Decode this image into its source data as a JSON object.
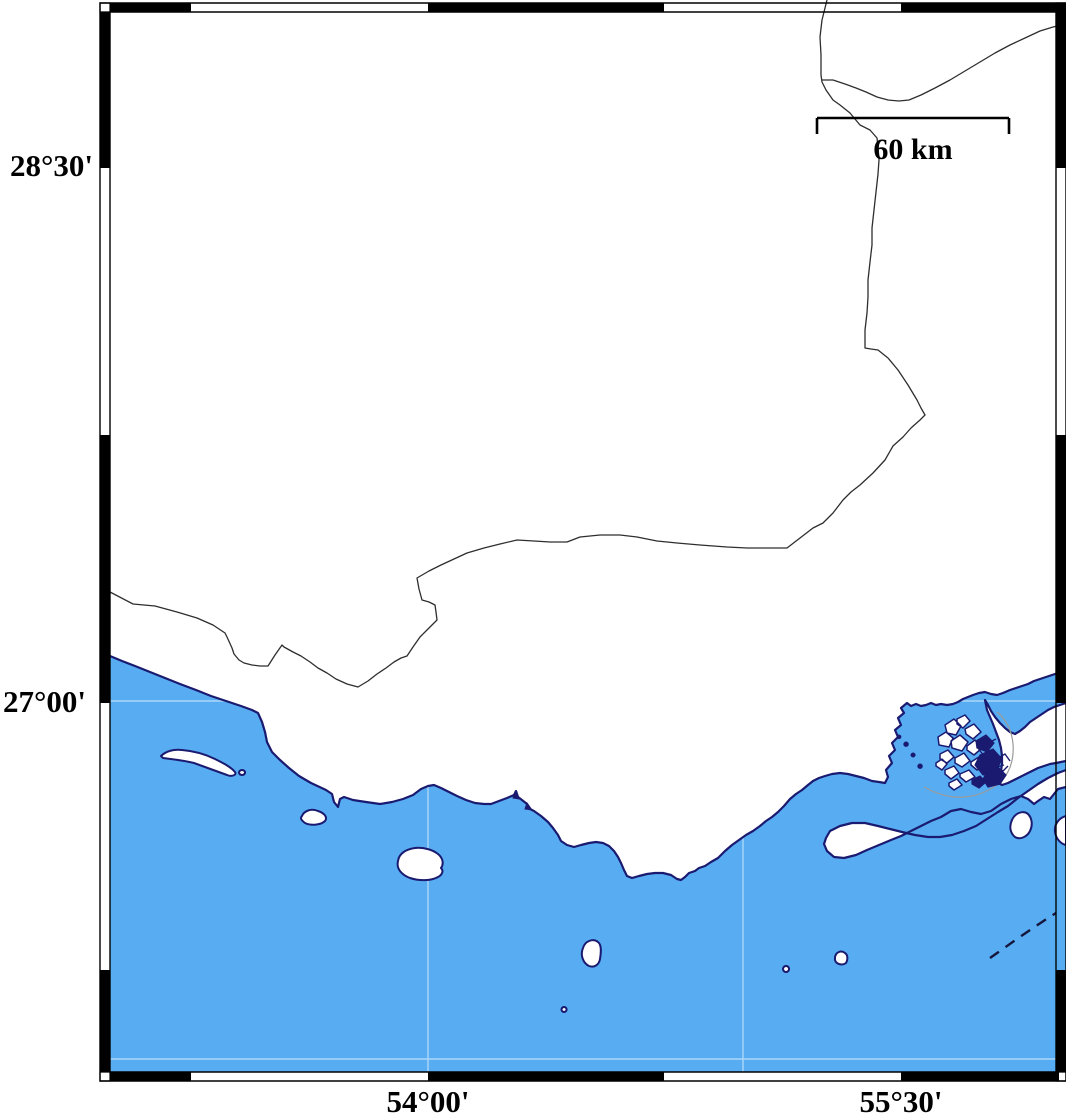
{
  "map": {
    "kind": "coastal map with fancy black-and-white graticule frame (GMT style)",
    "labels": {
      "lat_top": "28°30'",
      "lat_bottom": "27°00'",
      "lon_left": "54°00'",
      "lon_right": "55°30'",
      "scale": "60 km"
    },
    "scale_bar": {
      "label": "60 km",
      "x1": 817,
      "x2": 1009,
      "y": 118,
      "length_px": 192
    },
    "graticule": {
      "latitude_annotations": [
        {
          "text": "28°30'",
          "y": 168
        },
        {
          "text": "27°00'",
          "y": 703
        }
      ],
      "longitude_annotations": [
        {
          "text": "54°00'",
          "x": 428
        },
        {
          "text": "55°30'",
          "x": 901
        }
      ],
      "frame_alternation_px": 236.6
    },
    "colors": {
      "sea": "#58adf2",
      "land": "#ffffff",
      "coastline": "#1a1a70",
      "political_boundary": "#2e2e2e",
      "lagoon_outline": "#9a9a9a",
      "frame_ink": "#000000",
      "grid_seam": "rgba(255,255,255,0.5)"
    },
    "paths": {
      "sea": "M110,656 L122,661 L135,666 L150,672 L165,678 L180,684 L196,690 L211,696 L226,701 L241,706 L252,710 L258,713 L262,722 L265,732 L267,742 L272,752 L280,760 L289,768 L299,776 L311,783 L326,790 L332,794 L334,802 L338,807 L340,799 L344,797 L353,800 L366,802 L380,804 L392,802 L403,799 L413,795 L421,789 L428,786 L434,785 L441,788 L449,792 L457,796 L466,800 L475,803 L484,804 L491,804 L499,801 L507,798 L514,795 L516,791 L518,797 L522,800 L527,804 L530,809 L534,811 L541,816 L548,822 L553,828 L558,835 L561,841 L567,845 L574,847 L581,845 L589,843 L596,842 L603,843 L609,846 L614,851 L618,857 L621,863 L624,870 L627,876 L632,878 L639,876 L647,874 L655,873 L663,873 L671,875 L677,879 L681,880 L685,877 L689,873 L695,871 L699,868 L705,866 L711,862 L718,858 L725,851 L732,845 L739,840 L746,835 L753,831 L760,826 L766,821 L772,817 L778,812 L784,806 L790,799 L796,794 L802,790 L808,785 L813,781 L819,778 L825,776 L832,774 L840,773 L848,774 L856,776 L864,778 L872,781 L879,782 L885,783 L888,777 L886,770 L892,763 L889,756 L895,750 L892,743 L898,737 L895,730 L901,725 L898,718 L904,713 L901,708 L907,703 L911,706 L916,704 L921,706 L926,705 L931,703 L936,705 L941,704 L947,705 L953,704 L958,702 L963,699 L968,697 L973,695 L979,693 L985,692 L991,694 L997,695 L1003,693 L1010,690 L1016,688 L1022,686 L1028,684 L1034,681 L1040,679 L1046,677 L1052,675 L1058,673 L1062,672 L1066,671 L1066,703 L1060,705 L1054,707 L1048,710 L1042,714 L1036,718 L1030,722 L1025,727 L1020,731 L1015,734 L1010,732 L1005,728 L1000,723 L995,717 L991,711 L988,705 L985,700 L987,710 L990,717 L993,724 L996,732 L999,740 L1001,748 L1002,756 L1002,764 L1001,771 L999,777 L996,782 L1002,785 L1008,783 L1014,780 L1020,777 L1026,774 L1032,771 L1038,768 L1044,766 L1050,764 L1056,763 L1061,762 L1066,761 L1066,770 L1058,773 L1048,778 L1038,784 L1028,791 L1018,798 L1008,806 L998,812 L987,819 L976,826 L964,831 L952,835 L940,837 L928,837 L915,835 L902,832 L890,829 L878,826 L865,823 L852,823 L840,826 L830,831 L826,838 L824,844 L827,851 L834,857 L844,858 L856,855 L867,850 L879,845 L891,840 L901,836 L911,831 L921,826 L931,821 L941,817 L951,811 L961,809 L971,812 L981,814 L991,811 L1001,804 L1011,799 L1021,796 L1028,799 L1034,804 L1038,801 L1044,797 L1050,799 L1054,794 L1058,789 L1062,788 L1066,787 L1066,1072 L110,1072 Z",
      "coast_outline": "M110,656 L122,661 L135,666 L150,672 L165,678 L180,684 L196,690 L211,696 L226,701 L241,706 L252,710 L258,713 L262,722 L265,732 L267,742 L272,752 L280,760 L289,768 L299,776 L311,783 L326,790 L332,794 L334,802 L338,807 L340,799 L344,797 L353,800 L366,802 L380,804 L392,802 L403,799 L413,795 L421,789 L428,786 L434,785 L441,788 L449,792 L457,796 L466,800 L475,803 L484,804 L491,804 L499,801 L507,798 L514,795 L516,791 L518,797 L522,800 L527,804 L530,809 L534,811 L541,816 L548,822 L553,828 L558,835 L561,841 L567,845 L574,847 L581,845 L589,843 L596,842 L603,843 L609,846 L614,851 L618,857 L621,863 L624,870 L627,876 L632,878 L639,876 L647,874 L655,873 L663,873 L671,875 L677,879 L681,880 L685,877 L689,873 L695,871 L699,868 L705,866 L711,862 L718,858 L725,851 L732,845 L739,840 L746,835 L753,831 L760,826 L766,821 L772,817 L778,812 L784,806 L790,799 L796,794 L802,790 L808,785 L813,781 L819,778 L825,776 L832,774 L840,773 L848,774 L856,776 L864,778 L872,781 L879,782 L885,783 L888,777 L886,770 L892,763 L889,756 L895,750 L892,743 L898,737 L895,730 L901,725 L898,718 L904,713 L901,708 L907,703 L911,706 L916,704 L921,706 L926,705 L931,703 L936,705 L941,704 L947,705 L953,704 L958,702 L963,699 L968,697 L973,695 L979,693 L985,692 L991,694 L997,695 L1003,693 L1010,690 L1016,688 L1022,686 L1028,684 L1034,681 L1040,679 L1046,677 L1052,675 L1058,673 L1062,672 L1066,671 M1066,703 L1060,705 L1054,707 L1048,710 L1042,714 L1036,718 L1030,722 L1025,727 L1020,731 L1015,734 L1010,732 L1005,728 L1000,723 L995,717 L991,711 L988,705 L985,700 L987,710 L990,717 L993,724 L996,732 L999,740 L1001,748 L1002,756 L1002,764 L1001,771 L999,777 L996,782 L1002,785 L1008,783 L1014,780 L1020,777 L1026,774 L1032,771 L1038,768 L1044,766 L1050,764 L1056,763 L1061,762 L1066,761 M1066,770 L1058,773 L1048,778 L1038,784 L1028,791 L1018,798 L1008,806 L998,812 L987,819 L976,826 L964,831 L952,835 L940,837 L928,837 L915,835 L902,832 L890,829 L878,826 L865,823 L852,823 L840,826 L830,831 L826,838 L824,844 L827,851 L834,857 L844,858 L856,855 L867,850 L879,845 L891,840 L901,836 L911,831 L921,826 L931,821 L941,817 L951,811 L961,809 L971,812 L981,814 L991,811 L1001,804 L1011,799 L1021,796 L1028,799 L1034,804 L1038,801 L1044,797 L1050,799 L1054,794 L1058,789 L1062,788 L1066,787",
      "islands": "M161,756 C166,751 174,749 182,750 C194,751 205,754 215,759 C223,763 231,767 235,772 C237,775 232,777 227,775 C216,771 205,767 194,763 C182,760 170,759 163,758 Z M242,770 a3,2.5 0 1 0 0.1,0 Z M302,816 C304,811 311,808 318,811 C324,813 328,817 325,821 C321,825 311,826 305,823 C301,820 300,818 302,816 Z M398,861 C399,853 407,849 415,848 C424,847 433,850 438,854 C443,858 444,864 441,868 C444,871 442,875 438,877 C431,881 419,881 410,878 C402,875 396,869 398,861 Z M583,948 C585,941 593,938 598,942 C602,945 601,953 600,959 C599,965 594,968 589,966 C583,963 580,955 583,948 Z M564,1007 a2.5,2.5 0 1 0 0.1,0 Z M786,966 a3,3 0 1 0 0.1,0 Z M835,957 C836,952 841,950 845,953 C848,955 848,960 846,963 C842,966 836,964 835,960 Z M1012,820 C1015,813 1023,810 1028,814 C1032,818 1033,825 1030,831 C1027,837 1020,840 1015,837 C1010,833 1009,826 1012,820 Z M1066,816 C1059,818 1054,824 1055,832 C1056,839 1061,844 1066,845 Z",
      "bay_islets": "M906,742 a2.2,2.2 0 1 0 0.1,0 Z M913,753 a2,2 0 1 0 0.1,0 Z M920,764 a2.2,2.2 0 1 0 0.1,0 Z M899,735 a1.8,1.8 0 1 0 0.1,0 Z M515,792 l4,7 -6,-1 Z M527,803 l5,7 -7,-1 Z",
      "mangroves_white": "M945,725 l9,-6 7,7 -5,9 -9,-2 Z M957,719 l8,-4 5,6 -7,7 -6,-4 Z M965,729 l9,-5 7,8 -8,7 -7,-5 Z M938,737 l8,-5 7,6 -4,9 -10,-2 Z M951,741 l9,-6 8,7 -6,9 -10,-3 Z M967,746 l8,-6 7,8 -8,7 -7,-5 Z M940,754 l8,-4 6,7 -7,6 -7,-4 Z M955,758 l9,-5 6,8 -8,6 -7,-4 Z M971,762 l8,-5 7,8 -9,5 -6,-5 Z M945,770 l9,-4 5,7 -8,6 -6,-5 Z M960,774 l9,-4 6,7 -9,5 -6,-5 Z M936,763 l6,-4 5,5 -5,6 -6,-4 Z M949,783 l8,-4 5,6 -8,5 -5,-4 Z",
      "mangroves_solid": "M976,741 l10,-6 8,8 -7,9 -10,-4 Z M980,755 l13,-6 9,10 -6,12 -13,4 -8,-10 Z M987,772 l11,-5 8,8 -6,9 -12,3 -5,-8 Z M972,780 l8,-4 6,6 -7,6 -7,-4 Z",
      "mangroves_scribble": "M978,748 l6,8 -4,6 7,5 -3,7 M985,762 l8,-3 4,8 7,-2 M992,752 l6,6 7,-4 5,7 M996,768 l7,3 5,-5 M983,737 l7,5 6,-3",
      "lagoon_line": "M924,787 C937,794 951,798 964,797 C979,796 994,789 1003,779 C1011,770 1014,757 1013,744 C1012,731 1006,719 997,712",
      "boundary_main": "M110,592 L133,604 L155,606 L177,612 L197,618 L213,625 L225,633 L227,637 L232,648 L234,654 L239,660 L244,663 L252,665 L260,666 L268,666 L275,655 L282,645 L284,647 L293,652 L301,656 L310,662 L318,668 L327,673 L336,679 L347,684 L358,687 L368,681 L377,674 L386,668 L394,662 L401,658 L407,656 L413,647 L420,637 L429,628 L437,620 L436,612 L435,605 L429,602 L422,600 L419,589 L417,578 L429,571 L441,565 L454,559 L467,553 L484,548 L500,544 L517,540 L534,541 L550,542 L567,542 L580,537 L600,535 L620,535 L637,537 L657,541 L677,543 L700,545 L727,547 L747,548 L767,548 L787,548 L800,538 L813,528 L823,523 L833,513 L843,500 L851,492 L860,485 L873,473 L885,460 L893,446 L903,437 L911,428 L920,420 L925,415 L921,408 L917,400 L908,385 L898,370 L888,358 L878,350 L871,349 L865,348 L865,330 L867,313 L868,297 L868,280 L870,262 L872,245 L872,228 L874,210 L876,192 L878,174 L879,160 L878,147 L877,138 L870,130 L860,125 L850,113 L840,105 L833,100 L826,90 L822,82 L821,75 L821,55 L820,37 L822,20 L825,8 L827,0",
      "boundary_branch": "M822,80 L833,80 L845,84 L856,88 L866,92 L877,97 L888,100 L899,101 L909,100 L921,95 L935,88 L950,80 L965,71 L980,62 L995,53 L1010,45 L1025,38 L1040,31 L1053,27 L1066,24",
      "maritime_dashed": "M990,958 C1010,944 1032,928 1056,913",
      "grid_seams": "M428,780 L428,1072 M743,830 L743,1072 M110,701 L1066,701 M110,1059 L1056,1059",
      "frame_outline": "M100,3 H1066 V1081 H100 Z M110,12 H1056 V1072 H110 Z",
      "frame_ticks": "M110,3 H191 V12 H110 Z M428,3 H664 V12 H428 Z M901,3 H1066 V12 H901 Z M110,1072 H191 V1081 H110 Z M428,1072 H664 V1081 H428 Z M901,1072 H1059 V1081 H901 Z M100,12 H110 V168 H100 Z M100,435 H110 V703 H100 Z M100,970 H110 V1072 H100 Z M1056,3 H1066 V168 H1056 Z M1056,435 H1066 V703 H1056 Z M1056,970 H1066 V1072 H1056 Z",
      "frame_corners": "M100,3 h10 v9 h-10 Z M1056,3 h10 v9 h-10 Z M100,1072 h10 v9 h-10 Z M1056,1072 h10 v9 h-10 Z",
      "scalebar": "M817,118 H1009 M817,118 V134 M1009,118 V134"
    }
  }
}
